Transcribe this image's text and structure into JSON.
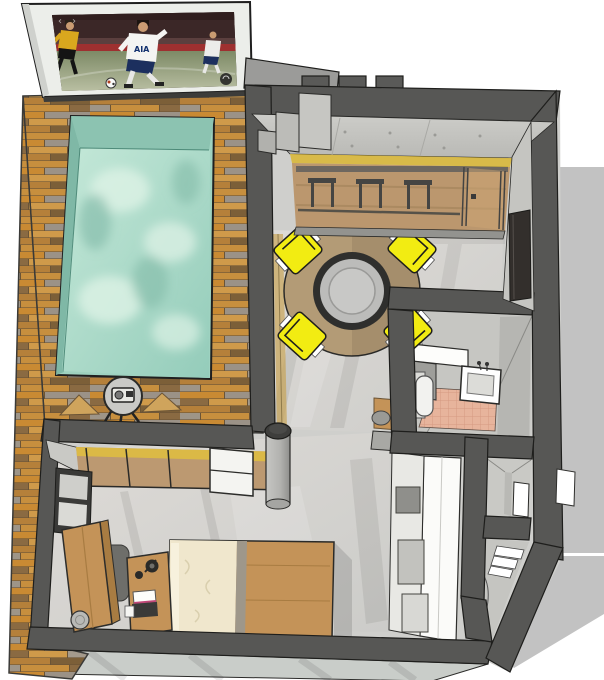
{
  "meta": {
    "type": "3d-floorplan-render",
    "style": "sketchup-like top-down perspective of a studio apartment with pool",
    "canvas": {
      "width": 604,
      "height": 680
    }
  },
  "tv": {
    "jersey_text": "AIA",
    "nav_prev": "‹",
    "nav_next": "›",
    "content": "football match, white-kit player with AIA jersey vs gold-kit player, ball on pitch"
  },
  "colors": {
    "background": "#ffffff",
    "wall_dark": "#575755",
    "wall_outline": "#1e1e1c",
    "concrete_wall": "#c7c7c3",
    "concrete_floor": "#d6d6d3",
    "deck_orange": "#c98a33",
    "deck_brown": "#8a6a42",
    "deck_gray": "#a49a8c",
    "pool_water": "#a8dcca",
    "pool_wall_shade": "#7fb8a6",
    "glass_tint_yellow": "#ddbc42",
    "armchair_yellow": "#f2ec12",
    "rug_tan": "#b39b76",
    "table_ring_dark": "#2f2f2d",
    "bathroom_tile_pink": "#e7b49c",
    "furniture_wood": "#c49358",
    "duvet_cream": "#f0e7cd",
    "exterior_shadow": "#c2c2c2",
    "fixture_white": "#fdfdfb"
  },
  "rooms": [
    {
      "name": "pool deck",
      "objects": [
        "wood plank decking",
        "swimming pool",
        "wall tv screen",
        "round side table",
        "radio",
        "folded loungers"
      ]
    },
    {
      "name": "living dining",
      "objects": [
        "round tan rug",
        "round table",
        "yellow armchair x4",
        "glass wall with yellow tint",
        "bar counter",
        "bar stools x3",
        "sliding door",
        "concrete column",
        "corner steps"
      ]
    },
    {
      "name": "kitchen",
      "objects": [
        "tall white cabinet run",
        "built-in oven openings",
        "counter slab",
        "wood end cabinet"
      ]
    },
    {
      "name": "bathroom",
      "objects": [
        "washbasin with faucet",
        "toilet",
        "wall shelf",
        "pink tile floor"
      ]
    },
    {
      "name": "bedroom",
      "objects": [
        "double bed with cream duvet",
        "desk",
        "laptop",
        "desk lamp",
        "desk chair",
        "wardrobe",
        "laundry basket",
        "glass partition",
        "white shelf unit",
        "framed wall panels"
      ]
    },
    {
      "name": "entry",
      "objects": [
        "white door opening",
        "louver steps",
        "door swing arc",
        "window cutout"
      ]
    }
  ]
}
